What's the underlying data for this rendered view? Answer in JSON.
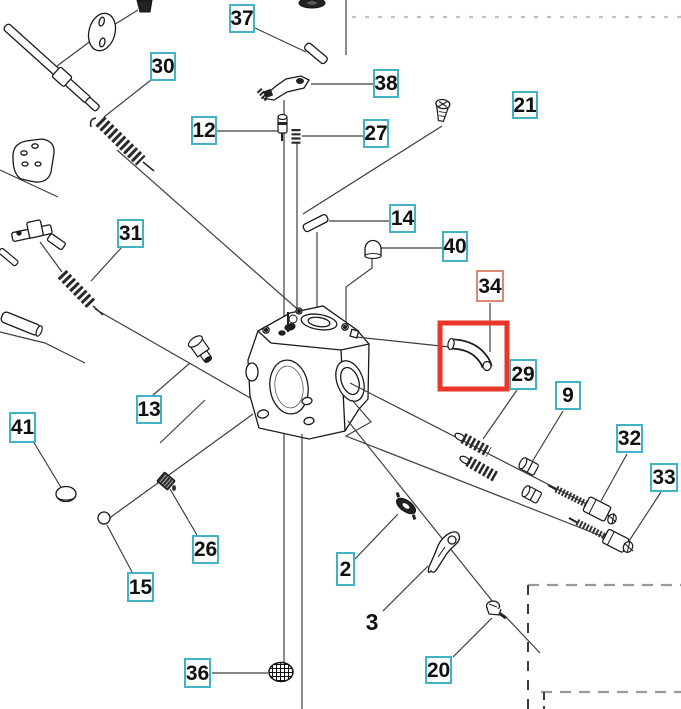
{
  "diagram": {
    "kind": "exploded-parts-diagram",
    "subject": "carburetor-assembly",
    "colors": {
      "label_border": "#41b3c4",
      "highlight_label_border": "#d98a74",
      "highlight_box": "#e8362a",
      "line": "#3f3f3f"
    },
    "highlighted_part_label": "34",
    "labels": [
      {
        "text": "37",
        "boxed": true,
        "highlighted": false
      },
      {
        "text": "30",
        "boxed": true,
        "highlighted": false
      },
      {
        "text": "12",
        "boxed": true,
        "highlighted": false
      },
      {
        "text": "38",
        "boxed": true,
        "highlighted": false
      },
      {
        "text": "27",
        "boxed": true,
        "highlighted": false
      },
      {
        "text": "21",
        "boxed": true,
        "highlighted": false
      },
      {
        "text": "31",
        "boxed": true,
        "highlighted": false
      },
      {
        "text": "14",
        "boxed": true,
        "highlighted": false
      },
      {
        "text": "40",
        "boxed": true,
        "highlighted": false
      },
      {
        "text": "34",
        "boxed": true,
        "highlighted": true
      },
      {
        "text": "29",
        "boxed": true,
        "highlighted": false
      },
      {
        "text": "9",
        "boxed": true,
        "highlighted": false
      },
      {
        "text": "32",
        "boxed": true,
        "highlighted": false
      },
      {
        "text": "33",
        "boxed": true,
        "highlighted": false
      },
      {
        "text": "13",
        "boxed": true,
        "highlighted": false
      },
      {
        "text": "41",
        "boxed": true,
        "highlighted": false
      },
      {
        "text": "26",
        "boxed": true,
        "highlighted": false
      },
      {
        "text": "15",
        "boxed": true,
        "highlighted": false
      },
      {
        "text": "2",
        "boxed": true,
        "highlighted": false
      },
      {
        "text": "3",
        "boxed": false,
        "highlighted": false
      },
      {
        "text": "20",
        "boxed": true,
        "highlighted": false
      },
      {
        "text": "36",
        "boxed": true,
        "highlighted": false
      }
    ]
  }
}
